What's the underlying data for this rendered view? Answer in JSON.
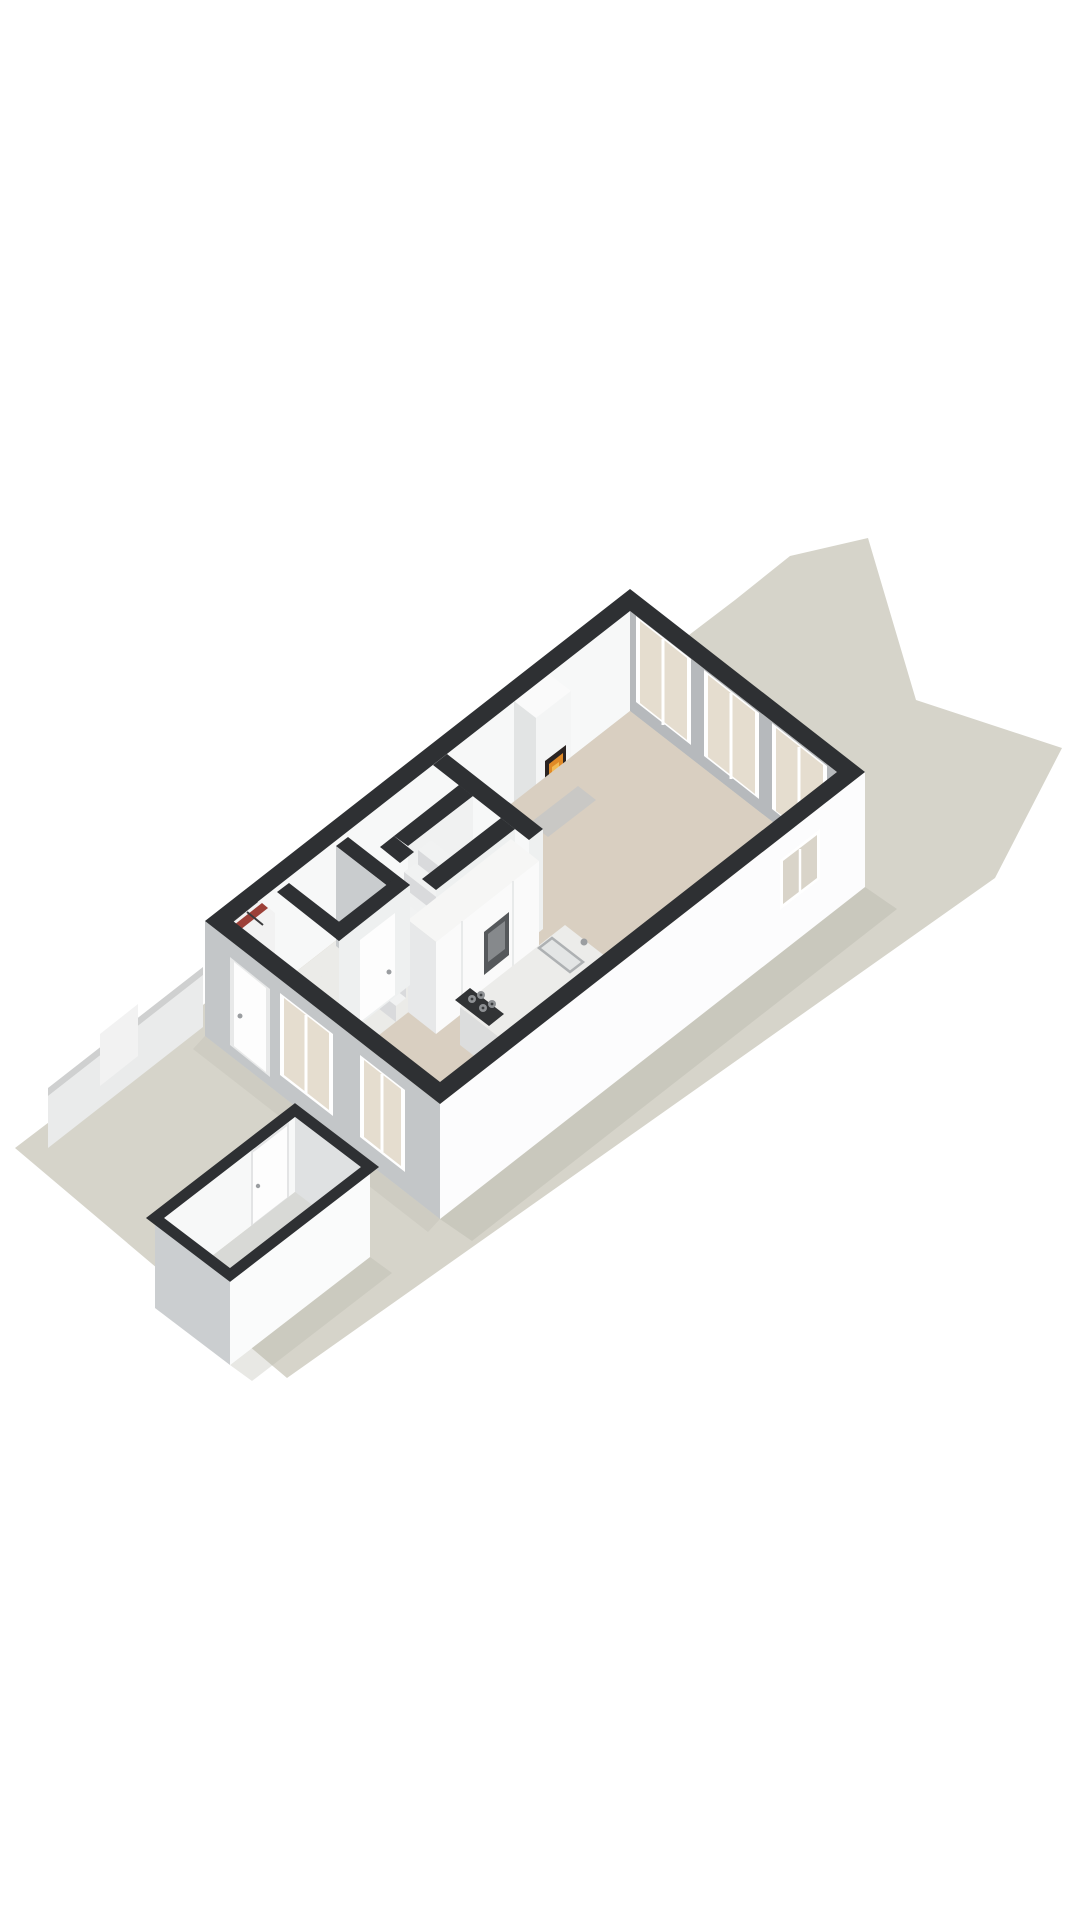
{
  "meta": {
    "kind": "3d-floorplan-render",
    "visible_text": []
  },
  "palette": {
    "background": "#ffffff",
    "plot": "#d6d4ca",
    "plot_shadow": "#b3b2a7",
    "cap": "#2e3033",
    "wall_lit": "#fcfcfd",
    "wall_sw_grey": "#c3c6c8",
    "wall_inner_white": "#f7f8f8",
    "wall_inner_grey": "#b6b9bc",
    "wall_mid": "#eef0f0",
    "wall_soft": "#f0f1f1",
    "floor_living": "#d9cfc1",
    "floor_hall": "#ebebe8",
    "floor_small": "#d9dad7",
    "floor_shed": "#d8d9d6",
    "glass_warm": "#e5ddcf",
    "glass_cool": "#d9d4c9",
    "frame_white": "#ffffff",
    "door_white": "#fdfdfd",
    "door_frame": "#e8e9e9",
    "cabinet_top": "#f6f6f5",
    "cabinet_face": "#fafafa",
    "cabinet_side": "#e7e8e9",
    "oven_dark": "#55585b",
    "oven_glass": "#86898c",
    "island_top": "#ececea",
    "island_lit": "#f2f2f1",
    "island_shadow": "#dcdddd",
    "cooktop": "#313335",
    "burner": "#8e9194",
    "burner_dot": "#3c3e40",
    "sink_fill": "#e3e5e5",
    "sink_edge": "#aeb1b3",
    "faucet": "#9b9ea1",
    "chimney_lit": "#f4f5f5",
    "chimney_shade": "#e2e4e4",
    "chimney_top": "#fafafa",
    "fire_dark": "#2b2422",
    "fire_orange": "#e08a27",
    "fire_yellow": "#f2b952",
    "hearth": "#c9c8c5",
    "step_top": "#f1f2f2",
    "step_front": "#d9dadc",
    "books_red": "#9c4038",
    "books_dark": "#3a3a3c",
    "shelf_white": "#f2f2f2",
    "wc_inner": "#c9ccce",
    "shed_sw": "#cbced0",
    "shed_inner": "#dfe1e2",
    "shed_face": "#fafbfb",
    "garden_wall": "#eaebeb",
    "garden_cap": "#cfd0d0",
    "handle": "#9a9da0",
    "joint": "#e3e4e5"
  },
  "objects": {
    "plot": "parcel-ground",
    "house": "main-house-cutaway",
    "rooms": [
      "living-room",
      "kitchen",
      "hall",
      "staircase",
      "wc"
    ],
    "features": [
      "fireplace",
      "kitchen-island",
      "cooktop",
      "sink",
      "tall-cabinets",
      "oven",
      "bookshelf",
      "front-door",
      "french-windows",
      "shed",
      "shed-door",
      "garden-wall"
    ]
  }
}
